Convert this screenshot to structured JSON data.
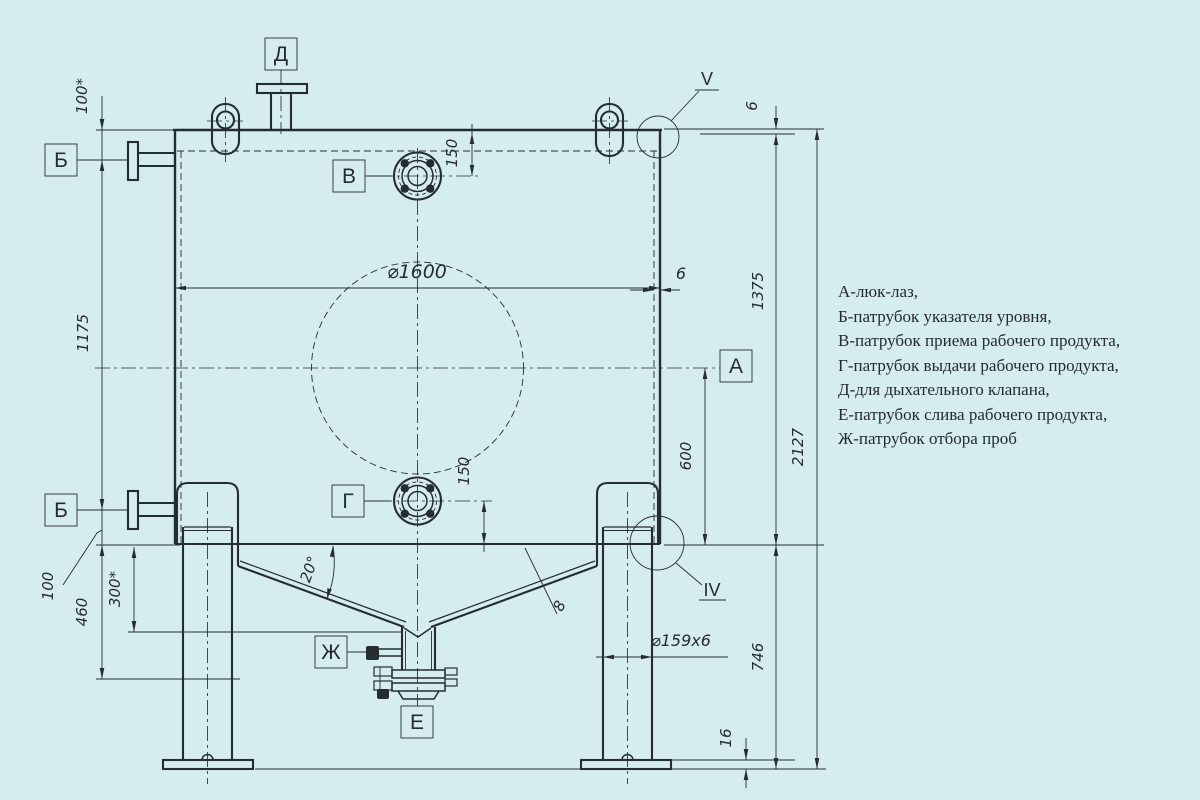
{
  "colors": {
    "background": "#d6edef",
    "line": "#262d30",
    "text": "#252b2e"
  },
  "legend": {
    "items": [
      "А-люк-лаз,",
      "Б-патрубок указателя уровня,",
      "В-патрубок приема рабочего продукта,",
      "Г-патрубок выдачи рабочего продукта,",
      "Д-для дыхательного клапана,",
      "Е-патрубок слива рабочего продукта,",
      "Ж-патрубок отбора проб"
    ]
  },
  "nozzle_labels": {
    "d": "Д",
    "b_upper": "Б",
    "b_lower": "Б",
    "v": "В",
    "g": "Г",
    "a": "А",
    "zh": "Ж",
    "e": "Е"
  },
  "detail_views": {
    "top_corner": "V",
    "leg_joint": "IV"
  },
  "dimensions": {
    "top_nozzle_offset": "100*",
    "level_gauge_span": "1175",
    "lower_nozzle_offset": "100",
    "cone_to_drain": "460",
    "cone_height": "300*",
    "inlet_depth": "150",
    "outlet_height": "150",
    "shell_inner_diameter": "⌀1600",
    "shell_wall_thickness": "6",
    "head_thickness": "6",
    "shell_height": "1375",
    "overall_height": "2127",
    "axis_to_cone": "600",
    "support_height": "746",
    "base_plate_thickness": "16",
    "leg_pipe": "⌀159x6",
    "cone_angle": "20°",
    "cone_wall_thickness": "8"
  }
}
